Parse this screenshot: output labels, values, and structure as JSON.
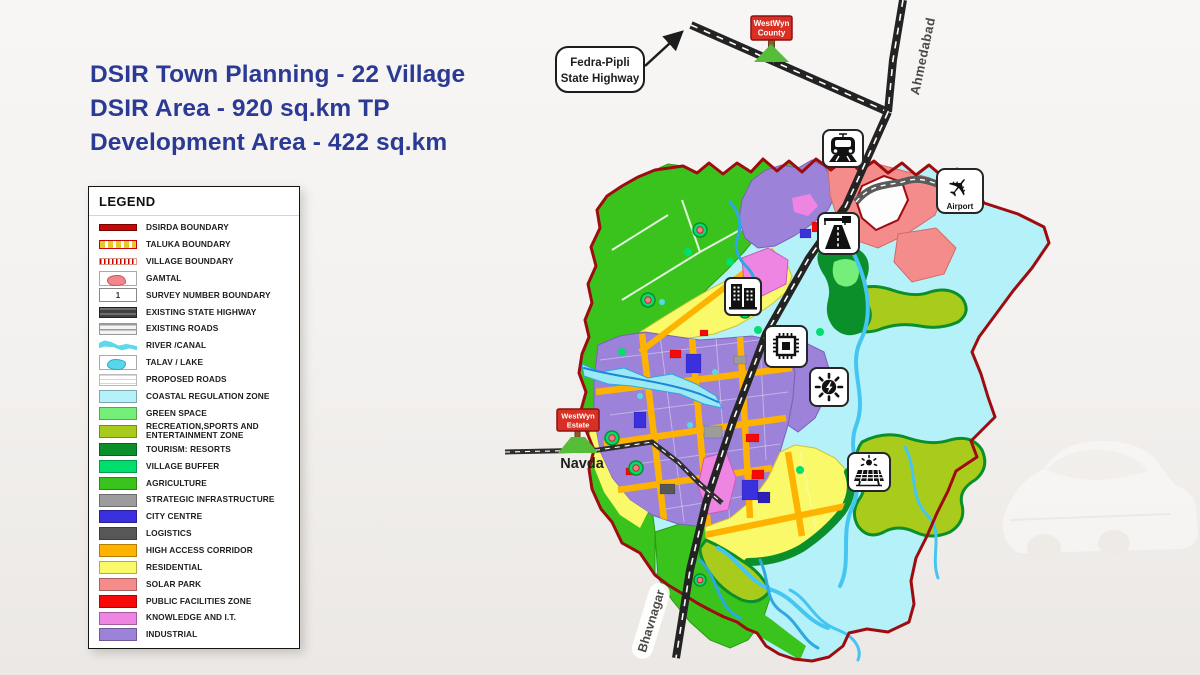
{
  "title": {
    "line1": "DSIR Town Planning - 22 Village",
    "line2": "DSIR Area - 920 sq.km TP",
    "line3": "Development Area - 422 sq.km"
  },
  "legend": {
    "heading": "LEGEND",
    "survey_number": "1",
    "items": [
      {
        "label": "DSIRDA BOUNDARY"
      },
      {
        "label": "TALUKA BOUNDARY"
      },
      {
        "label": "VILLAGE BOUNDARY"
      },
      {
        "label": "GAMTAL"
      },
      {
        "label": "SURVEY NUMBER BOUNDARY"
      },
      {
        "label": "EXISTING STATE HIGHWAY"
      },
      {
        "label": "EXISTING ROADS"
      },
      {
        "label": "RIVER /CANAL"
      },
      {
        "label": "TALAV / LAKE"
      },
      {
        "label": "PROPOSED ROADS"
      },
      {
        "label": "COASTAL REGULATION ZONE"
      },
      {
        "label": "GREEN SPACE"
      },
      {
        "label": "RECREATION,SPORTS AND ENTERTAINMENT ZONE"
      },
      {
        "label": "TOURISM: RESORTS"
      },
      {
        "label": "VILLAGE BUFFER"
      },
      {
        "label": "AGRICULTURE"
      },
      {
        "label": "STRATEGIC INFRASTRUCTURE"
      },
      {
        "label": "CITY CENTRE"
      },
      {
        "label": "LOGISTICS"
      },
      {
        "label": "HIGH ACCESS CORRIDOR"
      },
      {
        "label": "RESIDENTIAL"
      },
      {
        "label": "SOLAR PARK"
      },
      {
        "label": "PUBLIC FACILITIES ZONE"
      },
      {
        "label": "KNOWLEDGE AND I.T."
      },
      {
        "label": "INDUSTRIAL"
      }
    ]
  },
  "map": {
    "callout": {
      "line1": "Fedra-Pipli",
      "line2": "State Highway"
    },
    "signs": {
      "county": {
        "line1": "WestWyn",
        "line2": "County"
      },
      "estate": {
        "line1": "WestWyn",
        "line2": "Estate"
      }
    },
    "labels": {
      "ahmedabad": "Ahmedabad",
      "bhavnagar": "Bhavnagar",
      "navda": "Navda",
      "airport": "Airport"
    },
    "poi_icons": [
      "train-icon",
      "airport-icon",
      "expressway-icon",
      "city-buildings-icon",
      "semiconductor-chip-icon",
      "energy-icon",
      "solar-farm-icon"
    ]
  },
  "colors": {
    "title_text": "#2b3a94",
    "dsirda_boundary": "#9e0c10",
    "coastal_zone": "#b4f1f8",
    "green_space": "#76ee7a",
    "recreation_zone": "#a9cb1b",
    "tourism_resorts": "#0b8f2b",
    "village_buffer": "#00df6e",
    "agriculture": "#3bc31d",
    "strategic_infra": "#9c9c9c",
    "city_centre": "#3a30dd",
    "logistics": "#575757",
    "high_access_corridor": "#ffb301",
    "residential": "#f9f96a",
    "solar_park": "#f48c8c",
    "public_facilities": "#f60909",
    "knowledge_it": "#ee85e3",
    "industrial": "#9c82d8",
    "river": "#2fb9ea",
    "road": "#232323",
    "sign_red": "#d93025",
    "grass": "#56bd39"
  }
}
